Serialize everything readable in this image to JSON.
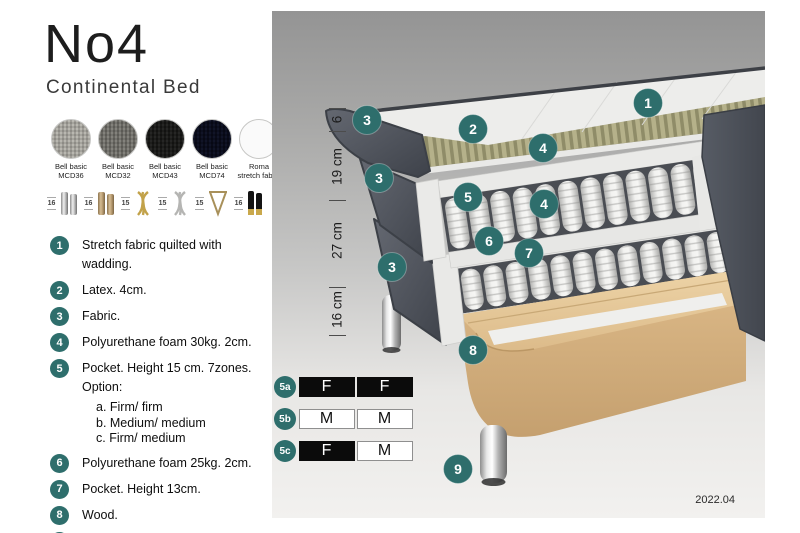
{
  "title": "No4",
  "subtitle": "Continental Bed",
  "colors": {
    "accent_teal": "#2e6e6c",
    "firm_cell_black": "#0b0b0b",
    "panel_gray_top": "#949494",
    "panel_gray_bottom": "#f2f1ef"
  },
  "fabrics": [
    {
      "line1": "Bell basic",
      "line2": "MCD36"
    },
    {
      "line1": "Bell basic",
      "line2": "MCD32"
    },
    {
      "line1": "Bell basic",
      "line2": "MCD43"
    },
    {
      "line1": "Bell basic",
      "line2": "MCD74"
    },
    {
      "line1": "Roma",
      "line2": "stretch fabric"
    }
  ],
  "leg_options": [
    {
      "height": "16",
      "style": "chrome-cylinder-pair"
    },
    {
      "height": "16",
      "style": "bronze-cylinder-pair"
    },
    {
      "height": "15",
      "style": "gold-twisted"
    },
    {
      "height": "15",
      "style": "silver-twisted"
    },
    {
      "height": "15",
      "style": "hairpin"
    },
    {
      "height": "16",
      "style": "black-gold-pair"
    }
  ],
  "spec_items": [
    {
      "num": "1",
      "text": "Stretch fabric quilted with wadding."
    },
    {
      "num": "2",
      "text": "Latex. 4cm."
    },
    {
      "num": "3",
      "text": "Fabric."
    },
    {
      "num": "4",
      "text": "Polyurethane foam 30kg. 2cm."
    },
    {
      "num": "5",
      "text": "Pocket. Height 15 cm. 7zones. Option:",
      "options": [
        "a. Firm/ firm",
        "b. Medium/ medium",
        "c. Firm/ medium"
      ]
    },
    {
      "num": "6",
      "text": "Polyurethane foam 25kg. 2cm."
    },
    {
      "num": "7",
      "text": "Pocket. Height 13cm."
    },
    {
      "num": "8",
      "text": "Wood."
    },
    {
      "num": "9",
      "text": "Metal leg. Height 16cm."
    }
  ],
  "diagram": {
    "dimensions": [
      {
        "label": "6"
      },
      {
        "label": "19 cm"
      },
      {
        "label": "27 cm"
      },
      {
        "label": "16 cm"
      }
    ],
    "callouts": [
      "1",
      "2",
      "3",
      "4",
      "5",
      "4",
      "3",
      "6",
      "7",
      "3",
      "8",
      "9"
    ]
  },
  "firmness": {
    "rows": [
      {
        "label": "5a",
        "left": "F",
        "right": "F"
      },
      {
        "label": "5b",
        "left": "M",
        "right": "M"
      },
      {
        "label": "5c",
        "left": "F",
        "right": "M"
      }
    ]
  },
  "version": "2022.04"
}
